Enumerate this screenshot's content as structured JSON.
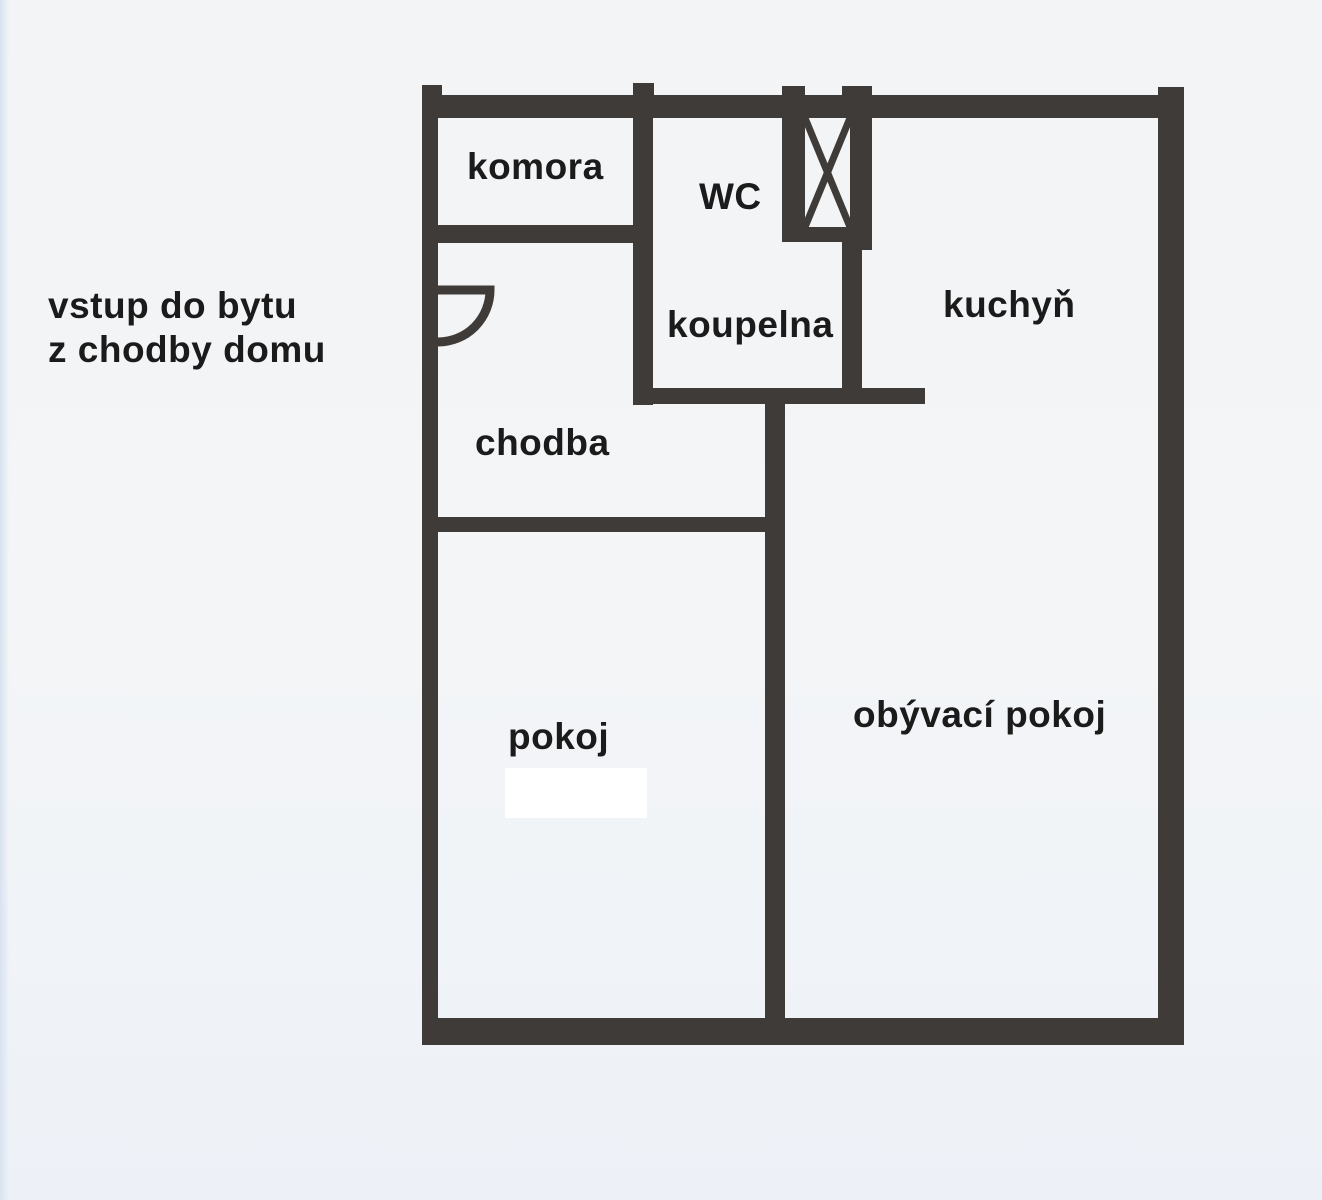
{
  "colors": {
    "wall": "#3f3b39",
    "text": "#1b1b1b",
    "paper": "#f2f4f6",
    "patch": "#ffffff",
    "scan_edge": "#d7e2f0"
  },
  "annotation": {
    "line1": "vstup do bytu",
    "line2": "z chodby domu"
  },
  "floorplan": {
    "labels": [
      {
        "id": "room-label-komora",
        "text": "komora",
        "x": 467,
        "y": 148
      },
      {
        "id": "room-label-wc",
        "text": "WC",
        "x": 699,
        "y": 178
      },
      {
        "id": "room-label-kuchyn",
        "text": "kuchyň",
        "x": 943,
        "y": 286
      },
      {
        "id": "room-label-koupelna",
        "text": "koupelna",
        "x": 667,
        "y": 306
      },
      {
        "id": "room-label-chodba",
        "text": "chodba",
        "x": 475,
        "y": 424
      },
      {
        "id": "room-label-pokoj",
        "text": "pokoj",
        "x": 508,
        "y": 718
      },
      {
        "id": "room-label-obyvaci-pokoj",
        "text": "obývací pokoj",
        "x": 853,
        "y": 696
      }
    ],
    "walls": [
      {
        "id": "wall-top",
        "x": 422,
        "y": 95,
        "w": 762,
        "h": 23
      },
      {
        "id": "wall-left",
        "x": 422,
        "y": 95,
        "w": 16,
        "h": 950
      },
      {
        "id": "wall-right",
        "x": 1158,
        "y": 87,
        "w": 26,
        "h": 958
      },
      {
        "id": "wall-bottom",
        "x": 422,
        "y": 1018,
        "w": 762,
        "h": 27
      },
      {
        "id": "wall-stub-top-left",
        "x": 422,
        "y": 85,
        "w": 20,
        "h": 12
      },
      {
        "id": "wall-stub-komora-wc",
        "x": 633,
        "y": 83,
        "w": 21,
        "h": 14
      },
      {
        "id": "wall-komora-bottom",
        "x": 430,
        "y": 225,
        "w": 223,
        "h": 18
      },
      {
        "id": "wall-komora-wc-divider",
        "x": 633,
        "y": 112,
        "w": 20,
        "h": 293
      },
      {
        "id": "wall-stub-shaft-left",
        "x": 782,
        "y": 86,
        "w": 23,
        "h": 11
      },
      {
        "id": "wall-shaft-left",
        "x": 782,
        "y": 112,
        "w": 23,
        "h": 130
      },
      {
        "id": "wall-shaft-bottom",
        "x": 782,
        "y": 227,
        "w": 90,
        "h": 15
      },
      {
        "id": "wall-stub-shaft-right",
        "x": 842,
        "y": 86,
        "w": 30,
        "h": 12
      },
      {
        "id": "wall-shaft-right",
        "x": 850,
        "y": 96,
        "w": 22,
        "h": 154
      },
      {
        "id": "wall-koupelna-right",
        "x": 842,
        "y": 240,
        "w": 20,
        "h": 163
      },
      {
        "id": "wall-koupelna-bottom",
        "x": 636,
        "y": 388,
        "w": 289,
        "h": 16
      },
      {
        "id": "wall-living-divider",
        "x": 765,
        "y": 395,
        "w": 20,
        "h": 650
      },
      {
        "id": "wall-chodba-pokoj",
        "x": 425,
        "y": 517,
        "w": 347,
        "h": 15
      }
    ],
    "door": {
      "hinge_x": 438,
      "hinge_y": 290,
      "radius": 52,
      "stroke": 9
    },
    "shaft": {
      "x": 805,
      "y": 118,
      "w": 45,
      "h": 109,
      "stroke": 7
    },
    "white_patch": {
      "x": 505,
      "y": 768,
      "w": 142,
      "h": 50
    }
  }
}
